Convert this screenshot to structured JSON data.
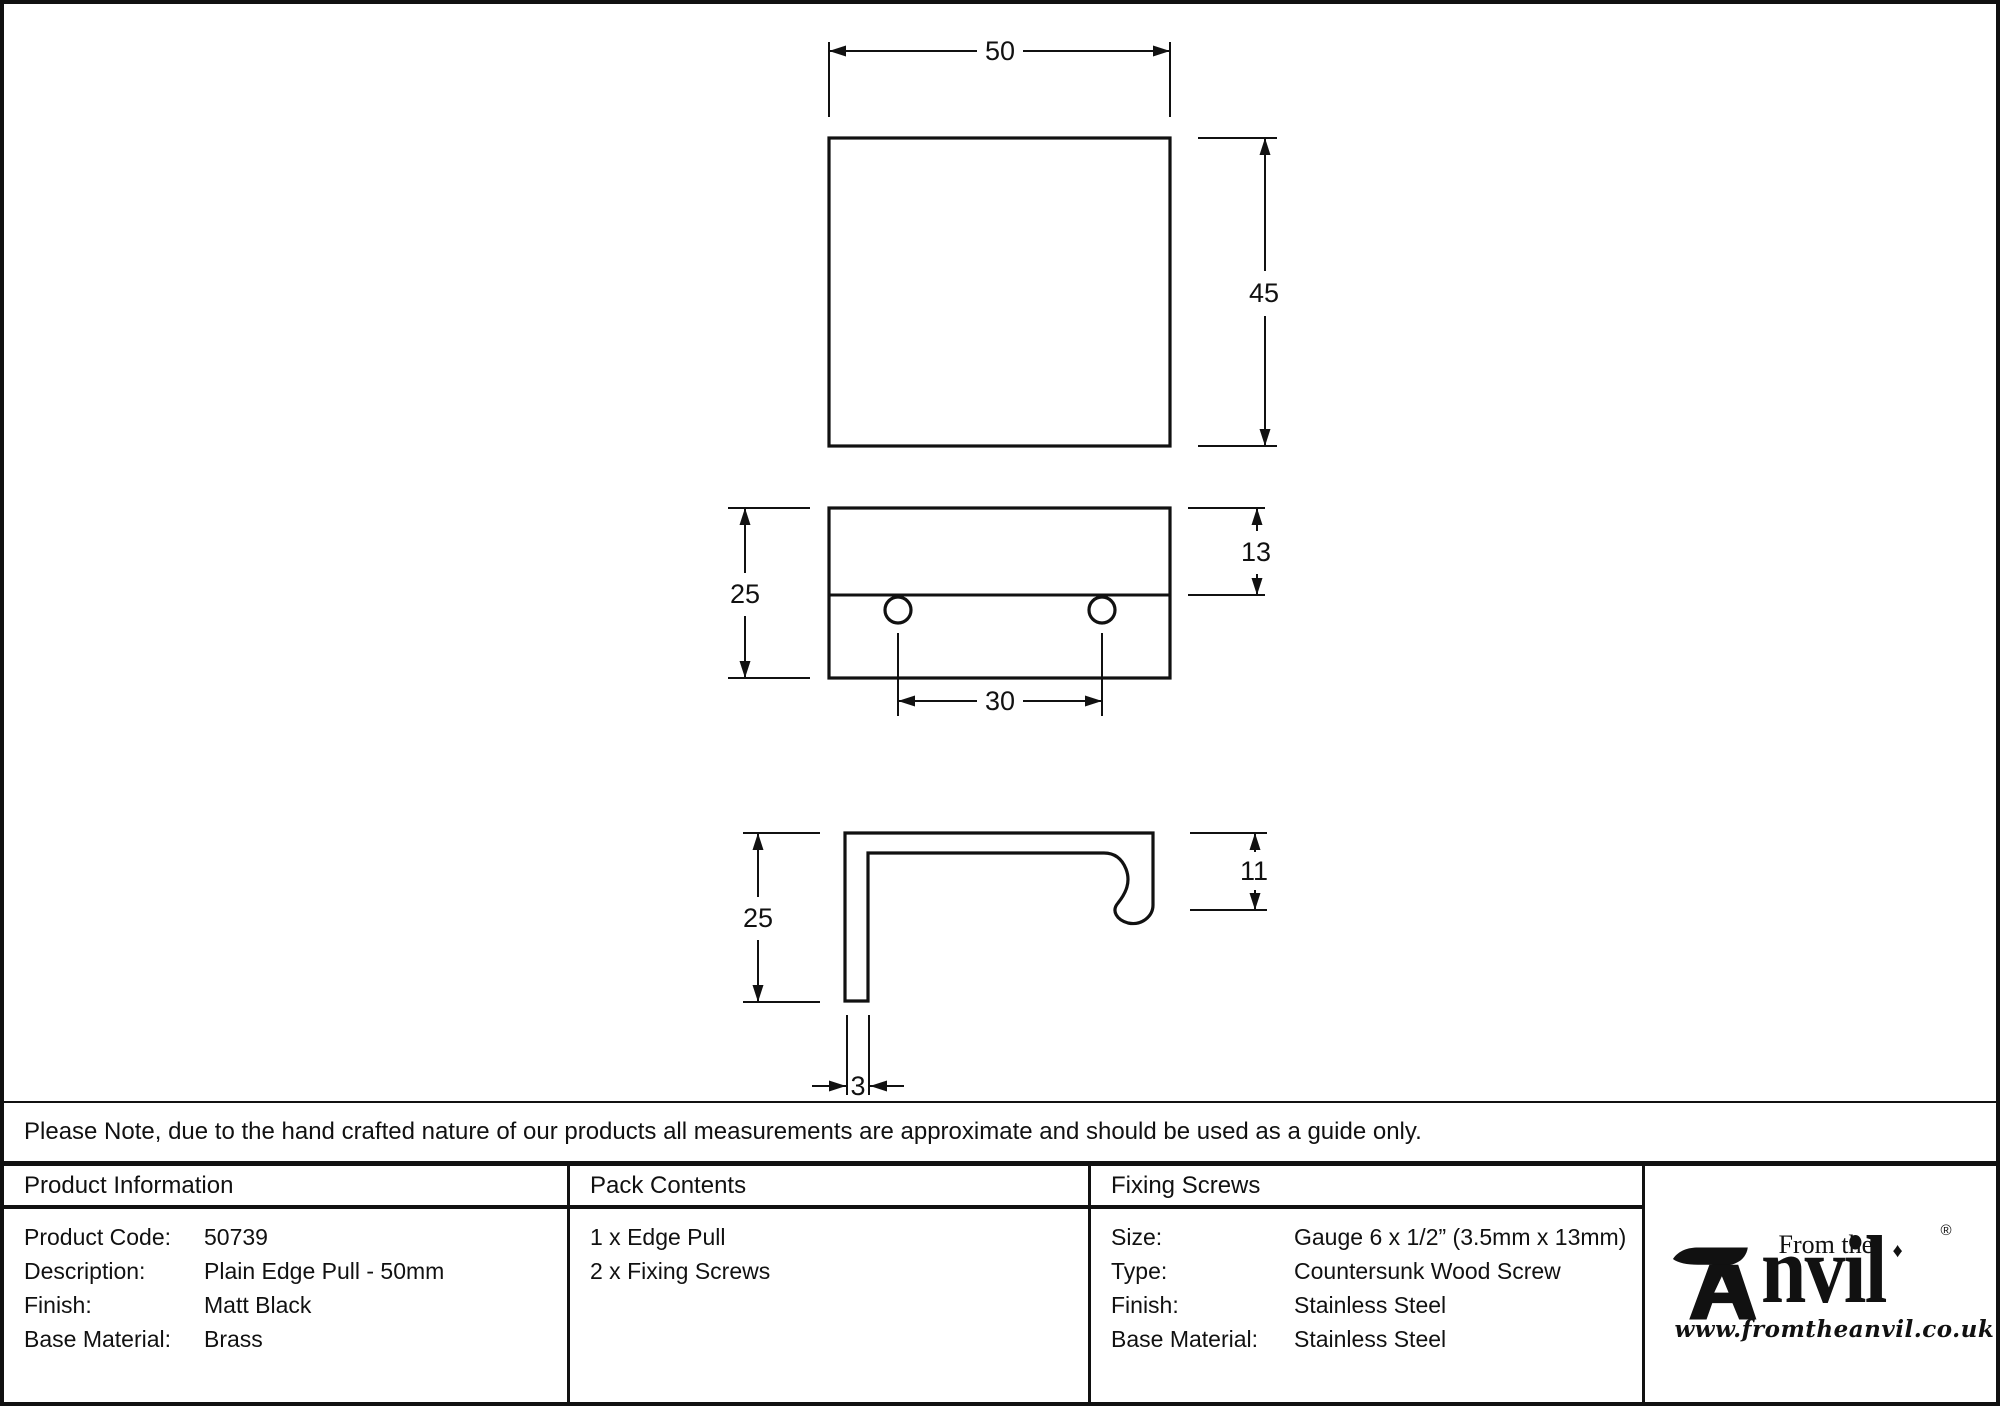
{
  "note": "Please Note, due to the hand crafted nature of our products all measurements are approximate and should be used as a guide only.",
  "drawing": {
    "top_view": {
      "width": "50",
      "height": "45"
    },
    "front_view": {
      "height": "25",
      "top_section": "13",
      "hole_spacing": "30"
    },
    "side_view": {
      "height": "25",
      "lip_height": "11",
      "thickness": "3"
    }
  },
  "table": {
    "product_information": {
      "header": "Product Information",
      "rows": [
        {
          "label": "Product Code:",
          "value": "50739"
        },
        {
          "label": "Description:",
          "value": "Plain Edge Pull - 50mm"
        },
        {
          "label": "Finish:",
          "value": "Matt Black"
        },
        {
          "label": "Base Material:",
          "value": "Brass"
        }
      ]
    },
    "pack_contents": {
      "header": "Pack Contents",
      "items": [
        "1 x Edge Pull",
        "2 x Fixing Screws"
      ]
    },
    "fixing_screws": {
      "header": "Fixing Screws",
      "rows": [
        {
          "label": "Size:",
          "value": "Gauge 6 x 1/2” (3.5mm x 13mm)"
        },
        {
          "label": "Type:",
          "value": "Countersunk Wood Screw"
        },
        {
          "label": "Finish:",
          "value": "Stainless Steel"
        },
        {
          "label": "Base Material:",
          "value": "Stainless Steel"
        }
      ]
    },
    "logo": {
      "brand_prefix": "From the",
      "diamond": "♦",
      "brand_name_rest": "nvil",
      "registered": "®",
      "url": "www.fromtheanvil.co.uk"
    }
  }
}
